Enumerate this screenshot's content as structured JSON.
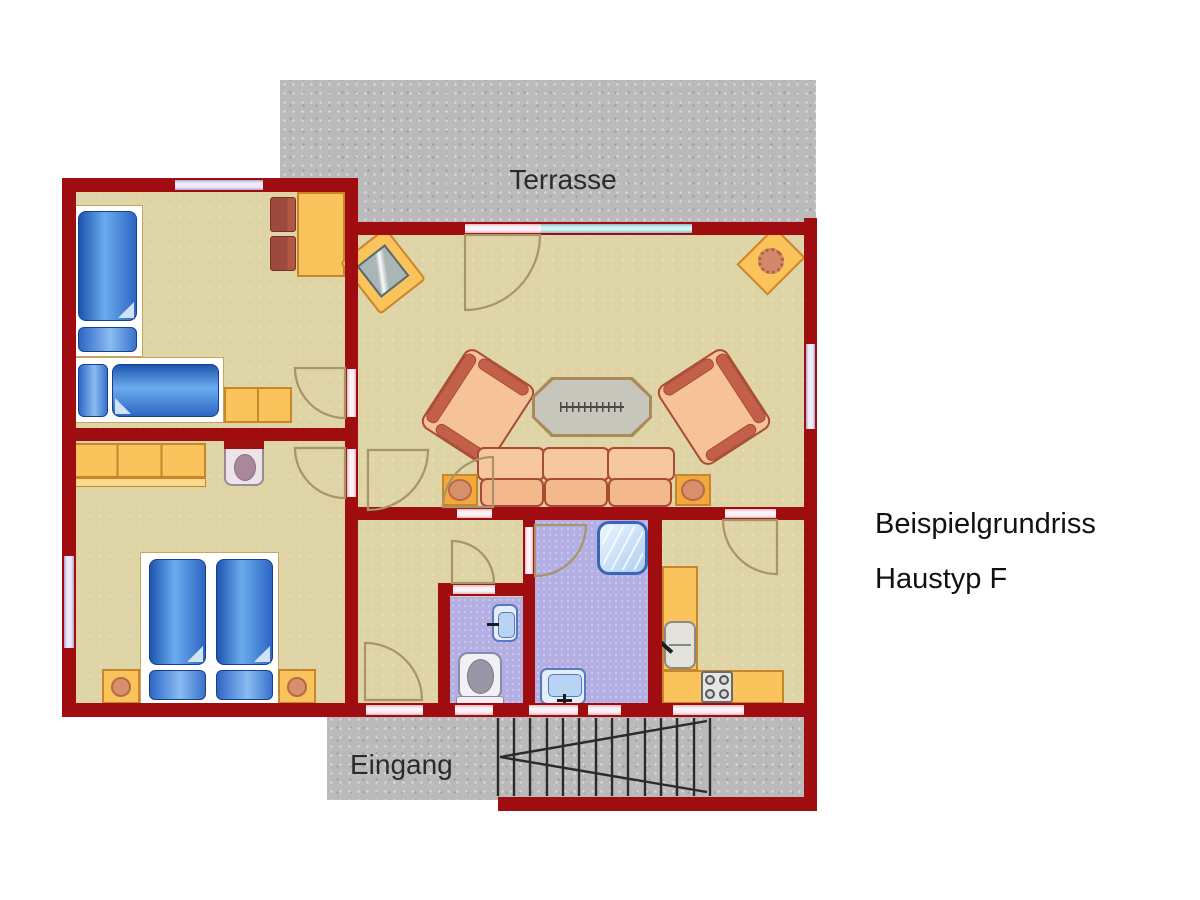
{
  "labels": {
    "terrace": "Terrasse",
    "entrance": "Eingang"
  },
  "title": {
    "line1": "Beispielgrundriss",
    "line2": "Haustyp F"
  },
  "colors": {
    "page_bg": "#ffffff",
    "wall": "#a00d10",
    "floor": "#ded4a6",
    "tile": "#b4afe2",
    "tile_dot": "#cac6f0",
    "concrete": "#bababa",
    "window_lavender_edge": "#b0a4d8",
    "window_lavender_fill": "#efecf8",
    "window_teal_edge": "#7ec4c4",
    "window_teal_fill": "#d8f2f2",
    "door_strip_edge": "#e8b2c2",
    "door_strip_fill": "#fbf4f6",
    "arc_stroke": "#a89468",
    "bed_blue_dark": "#1d55ae",
    "bed_blue_light": "#6aabee",
    "bed_border": "#16408c",
    "bed_fold": "#cfe2f8",
    "furniture_orange": "#fbc35c",
    "furniture_orange_border": "#c8862a",
    "upholstery": "#f6c298",
    "upholstery_border": "#a84a34",
    "upholstery_accent": "#c2604a",
    "table_gray": "#c6c6bc",
    "table_border": "#ab8a5a",
    "chair_dark": "#9c4a3e",
    "fixture_fill": "#e4eef8",
    "fixture_border": "#5a78c0",
    "fixture_inner": "#b8d4f2",
    "gray_fixture": "#9a96a8",
    "stair_line": "#2b2b2b",
    "label_text": "#2b2b2b",
    "title_text": "#111111"
  }
}
